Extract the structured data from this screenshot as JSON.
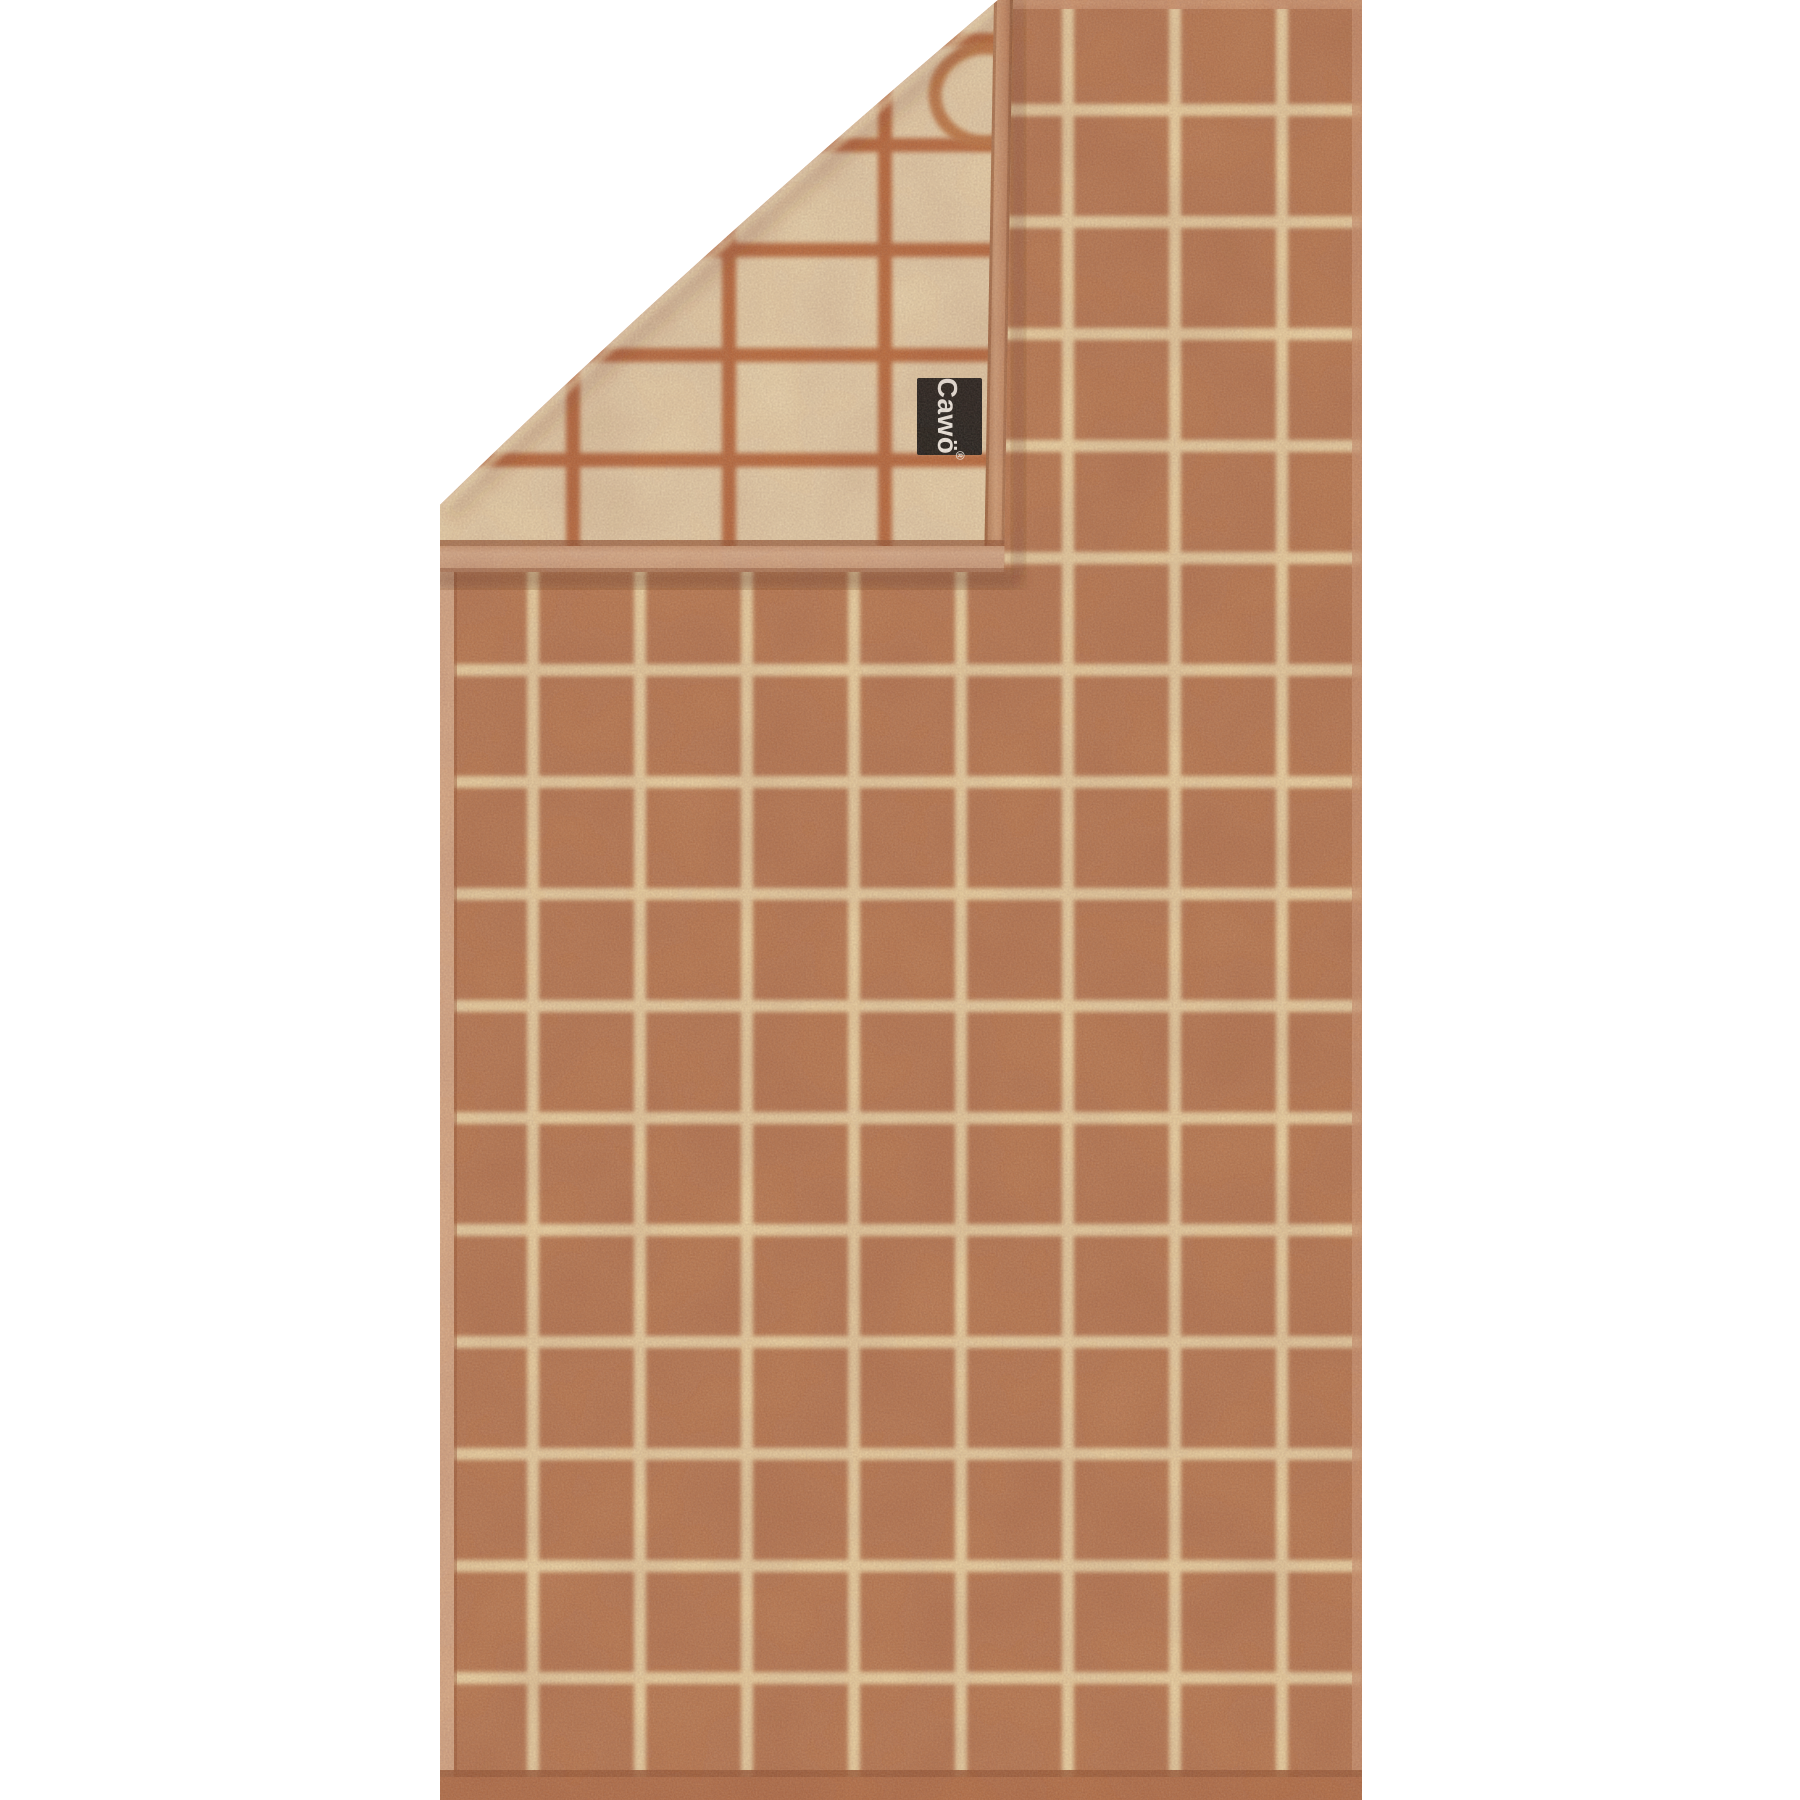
{
  "label": {
    "brand": "Cawö",
    "registered": "®"
  },
  "colors": {
    "background": "#ffffff",
    "towel_front": "#ba7a57",
    "front_grid": "#eed6ab",
    "back_face": "#ebd6b4",
    "back_grid": "#bc6c42",
    "fold_edge_strip": "#c68c6a",
    "fold_band": "#dcb294",
    "left_hem": "#dcae8f",
    "right_hem": "#d09a79",
    "top_hem": "#cf9674",
    "bottom_border": "#b5714e",
    "label_bg": "#191b1d",
    "label_text": "#f8f8f6",
    "ring_logo": "#c07848"
  }
}
